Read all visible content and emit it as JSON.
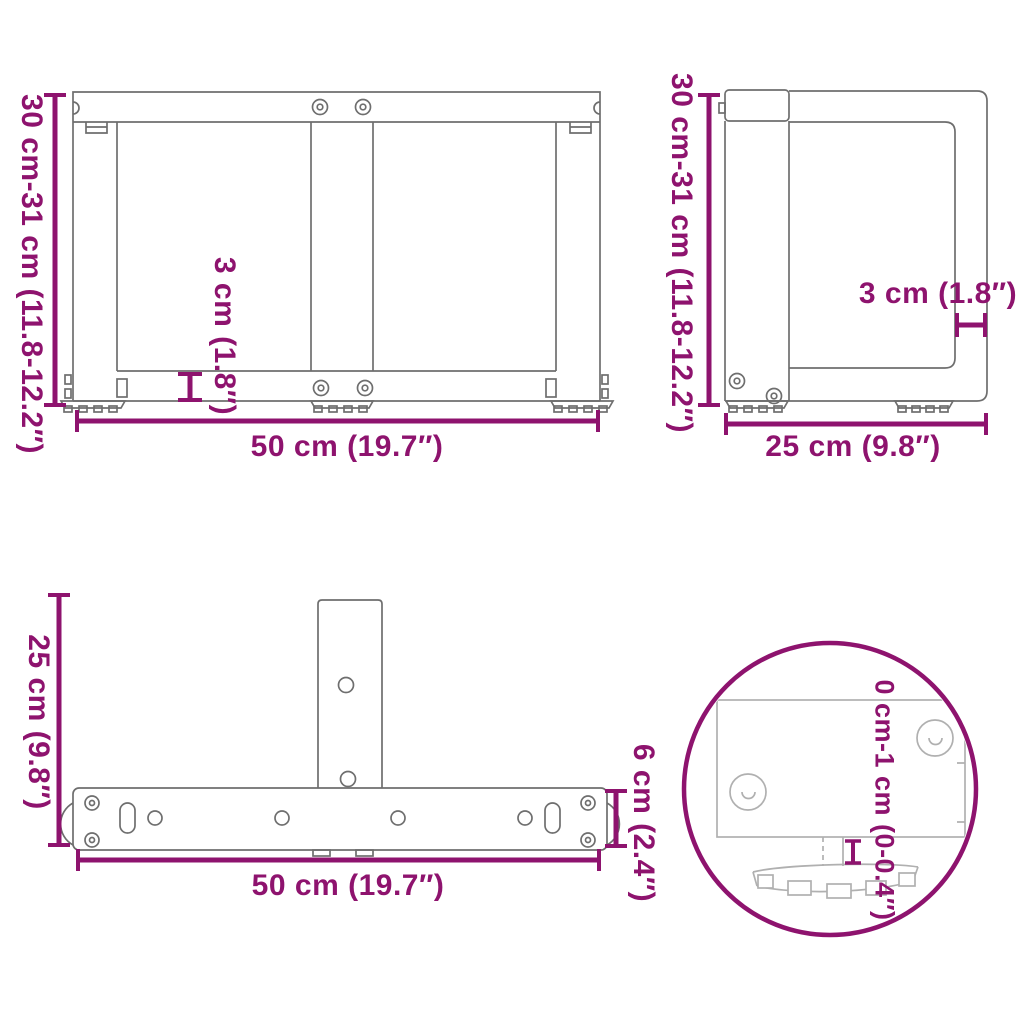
{
  "diagram_type": "furniture-table-leg-dimension-diagram",
  "colors": {
    "dimension_accent": "#8E136E",
    "line_art": "#6E6E6E",
    "detail_line_art": "#B0B0B0",
    "background": "#FFFFFF"
  },
  "views": {
    "front": {
      "name": "front view",
      "height": "30 cm-31 cm (11.8-12.2″)",
      "bar_thickness": "3 cm (1.8″)",
      "width": "50 cm (19.7″)"
    },
    "side": {
      "name": "side view",
      "height": "30 cm-31 cm (11.8-12.2″)",
      "panel_thickness": "3 cm (1.8″)",
      "depth": "25 cm (9.8″)"
    },
    "top": {
      "name": "top view",
      "depth": "25 cm (9.8″)",
      "bar_width": "6 cm (2.4″)",
      "width": "50 cm (19.7″)"
    },
    "foot_detail": {
      "name": "adjustable foot detail",
      "adjustment_range": "0 cm-1 cm (0-0.4″)"
    }
  }
}
